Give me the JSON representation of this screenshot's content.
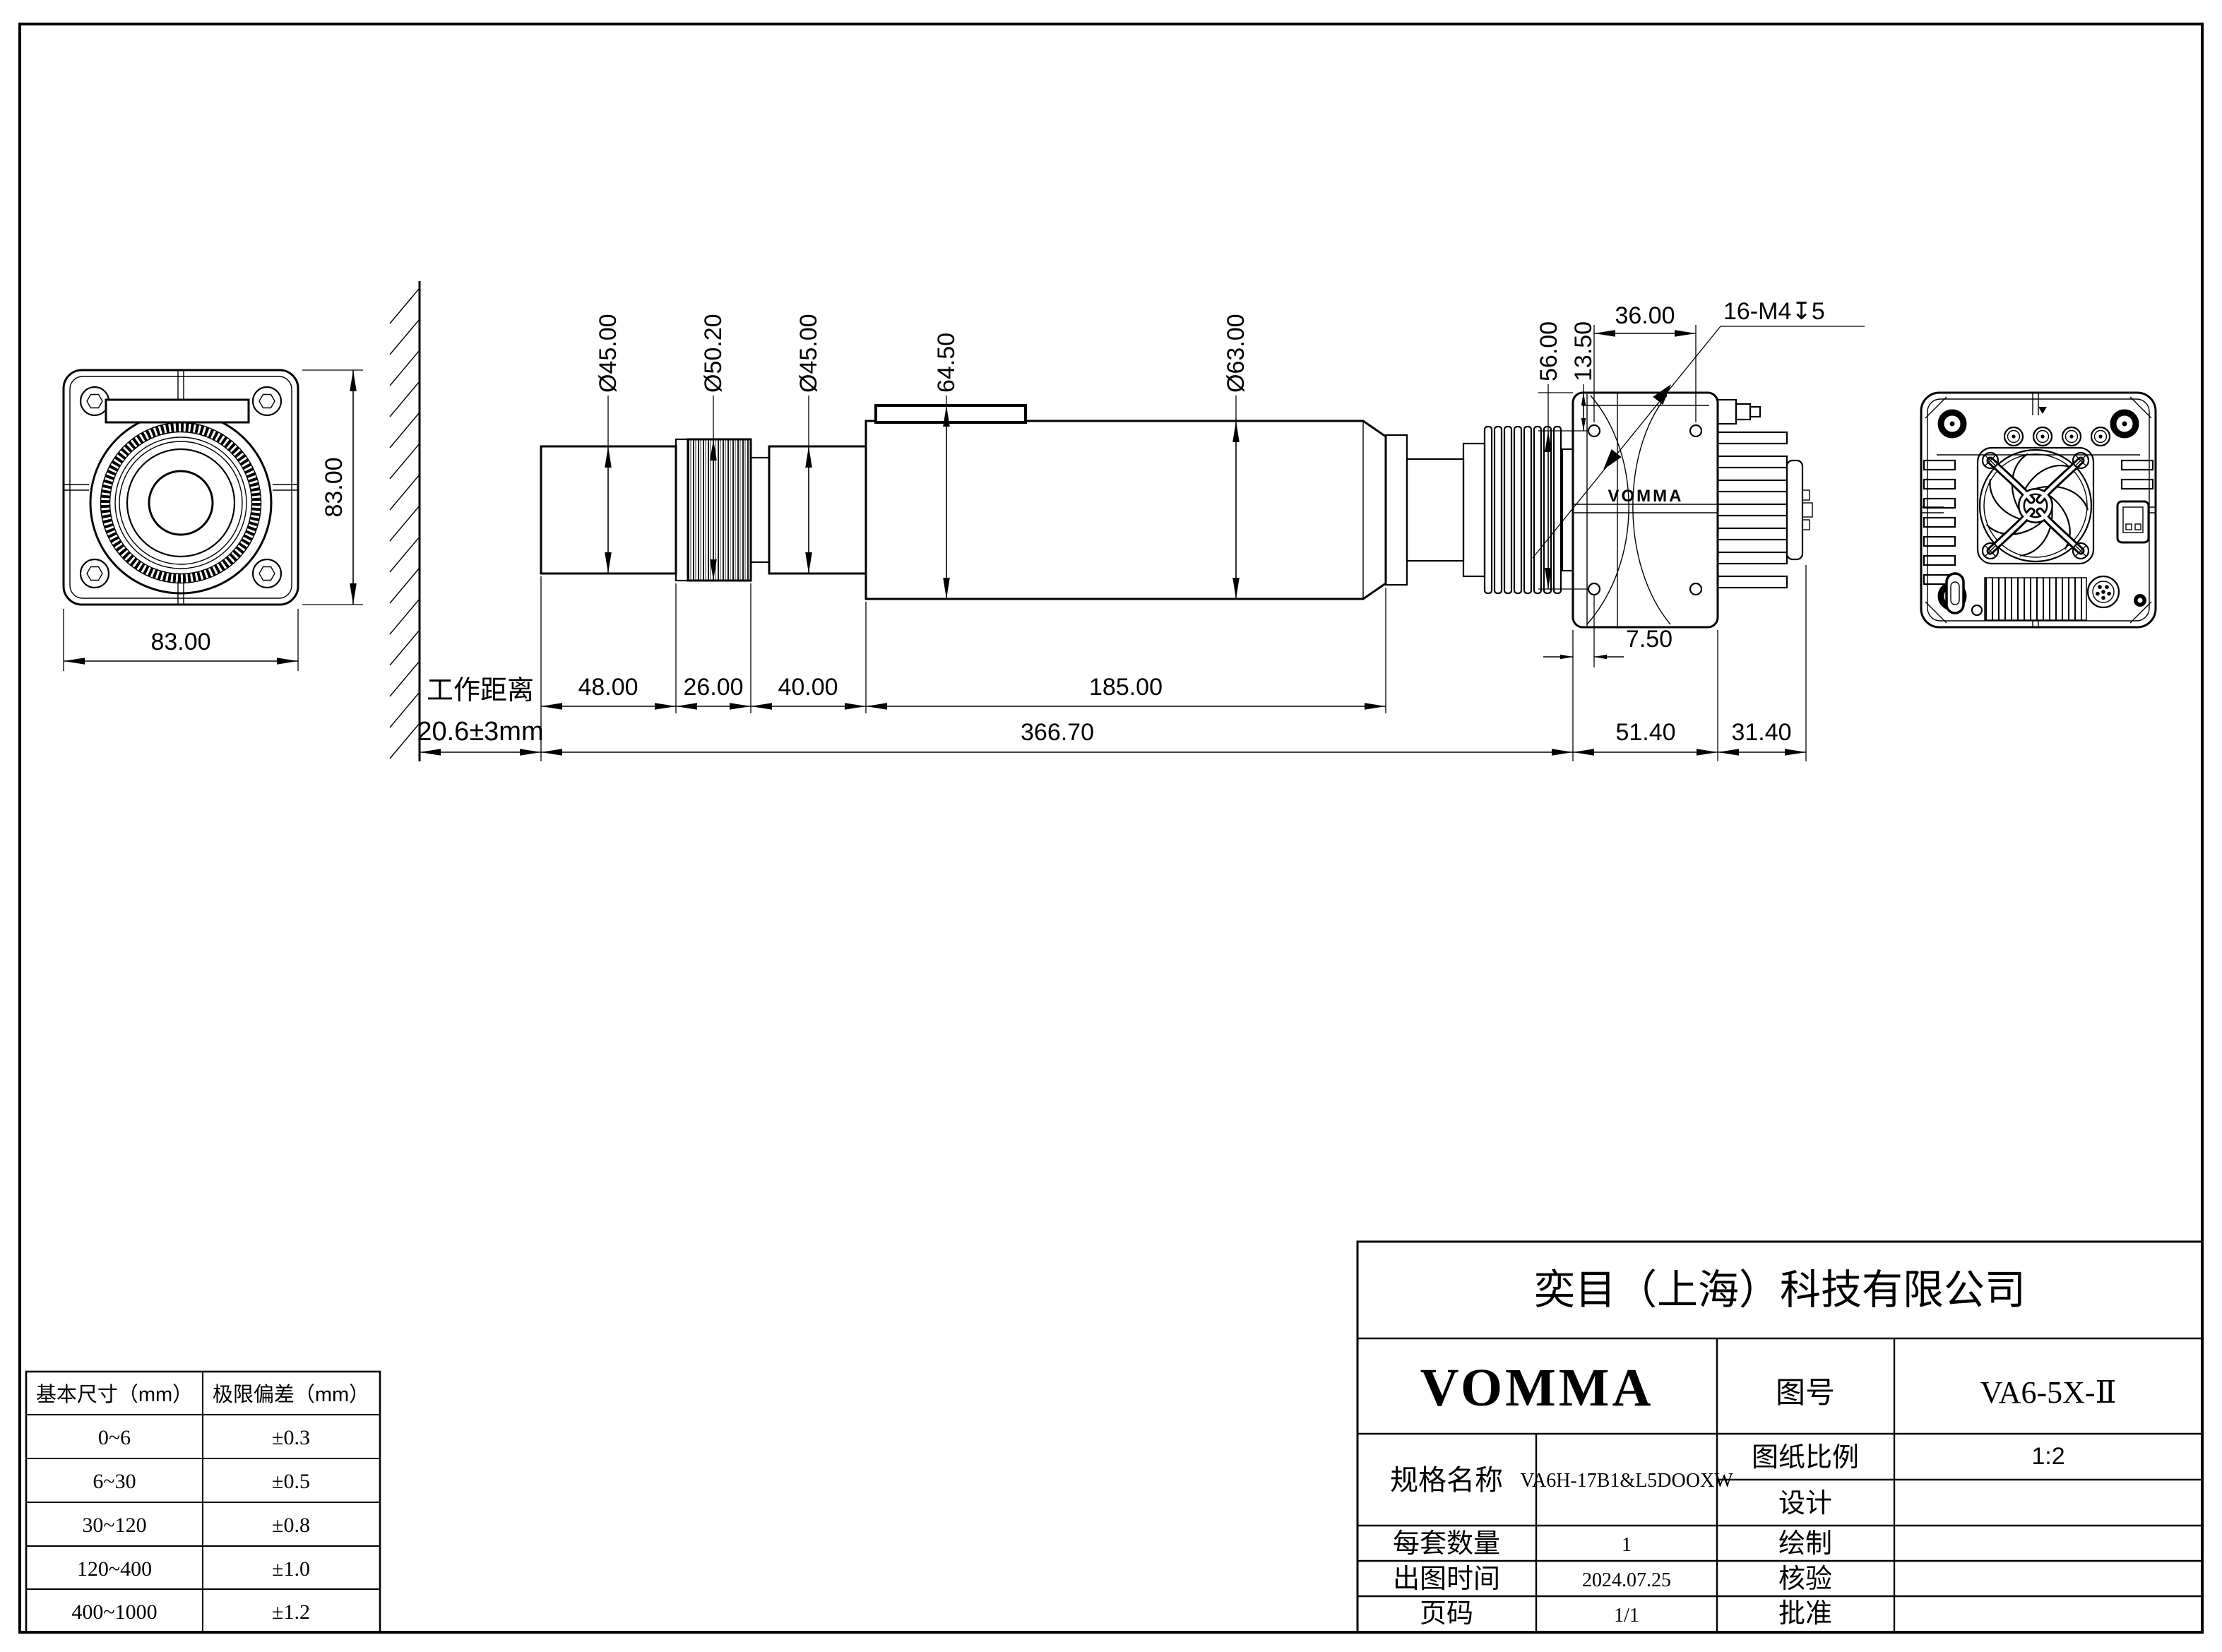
{
  "front_view": {
    "width": "83.00",
    "height": "83.00"
  },
  "side_view": {
    "wd_label": "工作距离",
    "wd_value": "20.6±3mm",
    "dia_lens_front": "Ø45.00",
    "dia_focus_ring": "Ø50.20",
    "dia_lens_rear": "Ø45.00",
    "height_rail": "64.50",
    "dia_body": "Ø63.00",
    "dim_hole_span": "56.00",
    "dim_hole_top": "13.50",
    "dim_hole_pitch": "36.00",
    "thread_note": "16-M4↧5",
    "len_lens_front": "48.00",
    "len_focus_ring": "26.00",
    "len_lens_rear": "40.00",
    "len_body": "185.00",
    "len_total": "366.70",
    "dim_hole_offset": "7.50",
    "len_camera": "51.40",
    "len_heatsink": "31.40",
    "logo": "VOMMA"
  },
  "tolerance_table": {
    "headers": [
      "基本尺寸（mm）",
      "极限偏差（mm）"
    ],
    "rows": [
      [
        "0~6",
        "±0.3"
      ],
      [
        "6~30",
        "±0.5"
      ],
      [
        "30~120",
        "±0.8"
      ],
      [
        "120~400",
        "±1.0"
      ],
      [
        "400~1000",
        "±1.2"
      ]
    ]
  },
  "title_block": {
    "company": "奕目（上海）科技有限公司",
    "brand": "VOMMA",
    "drawing_no_label": "图号",
    "drawing_no": "VA6-5X-Ⅱ",
    "spec_label": "规格名称",
    "spec_value": "VA6H-17B1&L5DOOXW",
    "scale_label": "图纸比例",
    "scale_value": "1:2",
    "design_label": "设计",
    "qty_label": "每套数量",
    "qty_value": "1",
    "draw_label": "绘制",
    "date_label": "出图时间",
    "date_value": "2024.07.25",
    "check_label": "核验",
    "page_label": "页码",
    "approve_label": "批准",
    "page_value": "1/1"
  }
}
